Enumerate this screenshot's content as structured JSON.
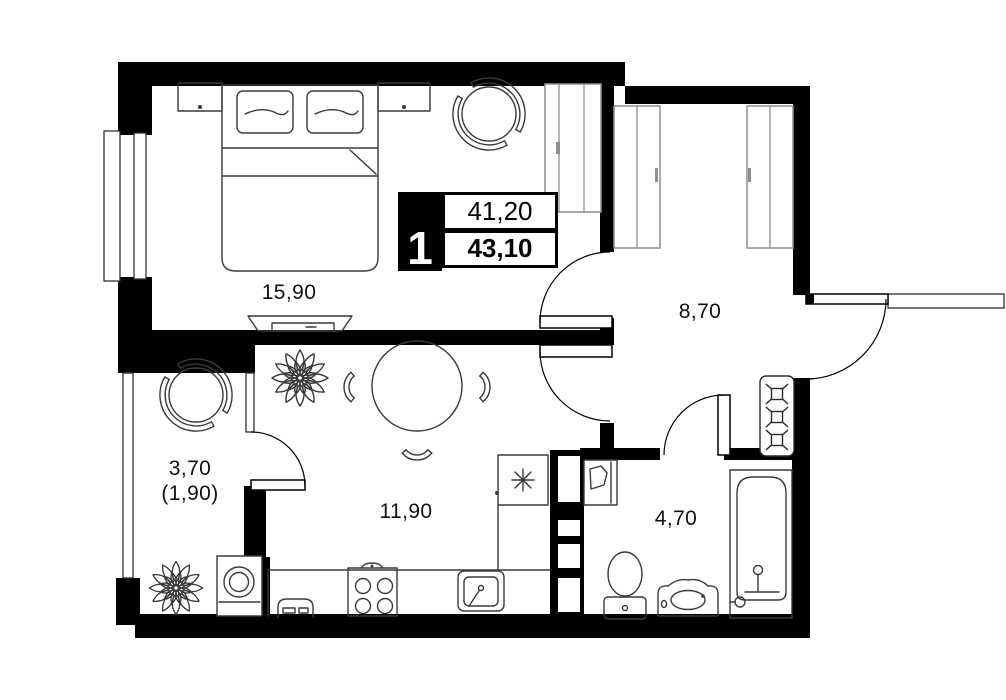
{
  "floor_plan": {
    "unit_badge": {
      "rooms": "1",
      "living_area": "41,20",
      "total_area": "43,10"
    },
    "rooms": {
      "bedroom": {
        "area": "15,90"
      },
      "hallway": {
        "area": "8,70"
      },
      "kitchen_living": {
        "area": "11,90"
      },
      "loggia": {
        "area": "3,70",
        "area_reduced": "(1,90)"
      },
      "bathroom": {
        "area": "4,70"
      }
    },
    "colors": {
      "walls": "#000000",
      "background": "#ffffff",
      "furniture": "#3a3a3a",
      "casework": "#8f8f8f"
    }
  }
}
